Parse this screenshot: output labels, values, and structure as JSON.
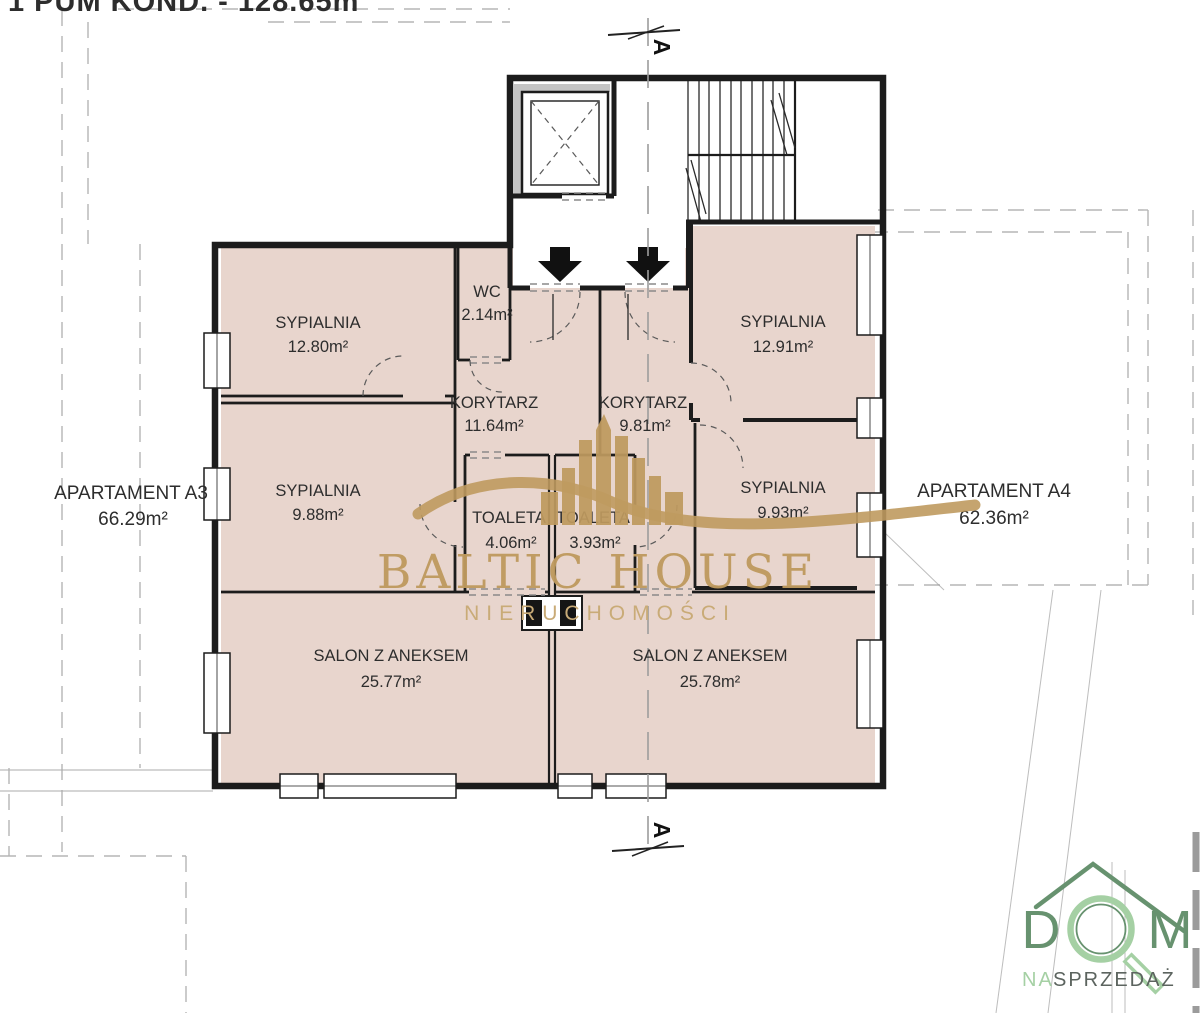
{
  "header": {
    "text": "1 PUM KOND. - 128.65m"
  },
  "section": {
    "label": "A"
  },
  "apartments": {
    "a3": {
      "name": "APARTAMENT A3",
      "area": "66.29m²"
    },
    "a4": {
      "name": "APARTAMENT A4",
      "area": "62.36m²"
    }
  },
  "rooms": {
    "sypialnia1": {
      "name": "SYPIALNIA",
      "area": "12.80m²"
    },
    "wc": {
      "name": "WC",
      "area": "2.14m²"
    },
    "korytarz_a3": {
      "name": "KORYTARZ",
      "area": "11.64m²"
    },
    "korytarz_a4": {
      "name": "KORYTARZ",
      "area": "9.81m²"
    },
    "sypialnia2": {
      "name": "SYPIALNIA",
      "area": "12.91m²"
    },
    "sypialnia3": {
      "name": "SYPIALNIA",
      "area": "9.88m²"
    },
    "toaleta1": {
      "name": "TOALETA",
      "area": "4.06m²"
    },
    "toaleta2": {
      "name": "TOALETA",
      "area": "3.93m²"
    },
    "sypialnia4": {
      "name": "SYPIALNIA",
      "area": "9.93m²"
    },
    "salon1": {
      "name": "SALON Z ANEKSEM",
      "area": "25.77m²"
    },
    "salon2": {
      "name": "SALON Z ANEKSEM",
      "area": "25.78m²"
    }
  },
  "watermark": {
    "brand": "BALTIC HOUSE",
    "tagline": "NIERUCHOMOŚCI"
  },
  "logo": {
    "letter_d": "D",
    "letter_m": "M",
    "sub_na": "NA",
    "sub_sprzedaz": "SPRZEDAŻ"
  },
  "colors": {
    "room_fill": "#e8d5cd",
    "wall": "#1c1c1c",
    "dashed_gray": "#b5b5b5",
    "watermark_gold": "#bf9a5f",
    "watermark_gold_light": "#c9ab77",
    "logo_green_dark": "#67926f",
    "logo_green_light": "#a5d0a4",
    "logo_gray": "#5c645f"
  }
}
